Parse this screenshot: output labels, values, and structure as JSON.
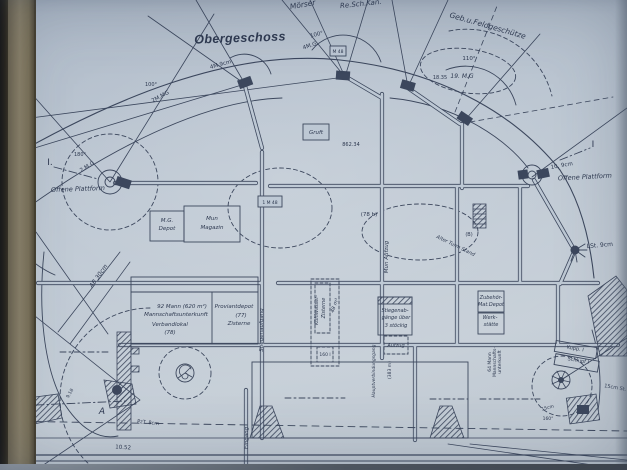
{
  "photo": {
    "frame_colors": {
      "outer": "#221c13",
      "inner": "#857b63",
      "edge_line": "#463f2f",
      "paper_edge": "#dbe1e9"
    },
    "paper_color": "#bdc8d4",
    "ink_color": "#2e3950",
    "shadow_color": "#545a61"
  },
  "plan": {
    "title": "Obergeschoss",
    "labels": [
      {
        "t": "Mörser",
        "x": 303,
        "y": 7,
        "s": 7.5,
        "r": -10,
        "i": 1
      },
      {
        "t": "Re.Sch.Kan.",
        "x": 361,
        "y": 6,
        "s": 7,
        "r": -6,
        "i": 1
      },
      {
        "t": "Geb.u.Feldgeschütze",
        "x": 487,
        "y": 28,
        "s": 7.5,
        "r": 16,
        "i": 1
      },
      {
        "t": "110°",
        "x": 469,
        "y": 60,
        "s": 5.5
      },
      {
        "t": "19. M.G",
        "x": 462,
        "y": 78,
        "s": 6,
        "i": 1
      },
      {
        "t": "100°",
        "x": 317,
        "y": 36,
        "s": 5.5,
        "r": -14
      },
      {
        "t": "4M.G.",
        "x": 311,
        "y": 47,
        "s": 5.5,
        "r": -18
      },
      {
        "t": "4M.9cm",
        "x": 221,
        "y": 66,
        "s": 5.5,
        "r": -16
      },
      {
        "t": "2M.MG",
        "x": 161,
        "y": 98,
        "s": 5.5,
        "r": -28
      },
      {
        "t": "100°",
        "x": 151,
        "y": 86,
        "s": 5
      },
      {
        "t": "2.M.G",
        "x": 88,
        "y": 168,
        "s": 5.5,
        "r": -32
      },
      {
        "t": "180°",
        "x": 80,
        "y": 156,
        "s": 5
      },
      {
        "t": "18.35",
        "x": 440,
        "y": 79,
        "s": 5
      },
      {
        "t": "I.",
        "x": 50,
        "y": 165,
        "s": 9
      },
      {
        "t": "Offene Plattform",
        "x": 78,
        "y": 191,
        "s": 6.5,
        "r": -2,
        "i": 1
      },
      {
        "t": "Offene Plattform",
        "x": 585,
        "y": 179,
        "s": 6.5,
        "r": -3,
        "i": 1
      },
      {
        "t": "10. 9cm",
        "x": 562,
        "y": 167,
        "s": 5.5,
        "r": -10
      },
      {
        "t": "I",
        "x": 593,
        "y": 147,
        "s": 9
      },
      {
        "t": "LSt. 9cm",
        "x": 600,
        "y": 247,
        "s": 6,
        "r": -5
      },
      {
        "t": "M.G.",
        "x": 167,
        "y": 222,
        "s": 5.5,
        "i": 1
      },
      {
        "t": "Depot",
        "x": 167,
        "y": 230,
        "s": 5.5,
        "i": 1
      },
      {
        "t": "Mun",
        "x": 212,
        "y": 220,
        "s": 5.5,
        "i": 1
      },
      {
        "t": "Magazin",
        "x": 212,
        "y": 229,
        "s": 5.5,
        "i": 1
      },
      {
        "t": "Gruft",
        "x": 316,
        "y": 134,
        "s": 5.5,
        "i": 1
      },
      {
        "t": "862.34",
        "x": 351,
        "y": 146,
        "s": 5
      },
      {
        "t": "1 M 48",
        "x": 270,
        "y": 204,
        "s": 4.5
      },
      {
        "t": "M 48",
        "x": 338,
        "y": 53,
        "s": 4.5
      },
      {
        "t": "(78 b)",
        "x": 369,
        "y": 216,
        "s": 5.5
      },
      {
        "t": "(B)",
        "x": 469,
        "y": 236,
        "s": 5
      },
      {
        "t": "Alter Turm Stand",
        "x": 455,
        "y": 247,
        "s": 5,
        "r": 26,
        "i": 1
      },
      {
        "t": "Mun Aufzug",
        "x": 388,
        "y": 257,
        "s": 5.5,
        "r": -90,
        "i": 1
      },
      {
        "t": "AB 30cm",
        "x": 100,
        "y": 277,
        "s": 6,
        "r": -55,
        "i": 1
      },
      {
        "t": "92 Mann (620 m²)",
        "x": 182,
        "y": 308,
        "s": 5.5,
        "i": 1
      },
      {
        "t": "Mannschaftsunterkunft",
        "x": 176,
        "y": 316,
        "s": 5.5,
        "i": 1
      },
      {
        "t": "Verbandlokal",
        "x": 170,
        "y": 326,
        "s": 5.5,
        "i": 1
      },
      {
        "t": "(78)",
        "x": 170,
        "y": 334,
        "s": 5.5,
        "i": 1
      },
      {
        "t": "Proviantdepot",
        "x": 234,
        "y": 308,
        "s": 5.5,
        "i": 1
      },
      {
        "t": "(77)",
        "x": 241,
        "y": 317,
        "s": 5.5,
        "i": 1
      },
      {
        "t": "Zisterne",
        "x": 239,
        "y": 325,
        "s": 5.5,
        "i": 1
      },
      {
        "t": "Stiegenaufgang",
        "x": 263,
        "y": 330,
        "s": 5.5,
        "r": -90,
        "i": 1
      },
      {
        "t": "Kühlwasser-",
        "x": 318,
        "y": 310,
        "s": 5,
        "r": -90,
        "i": 1
      },
      {
        "t": "Zisterne",
        "x": 325,
        "y": 308,
        "s": 5,
        "r": -90,
        "i": 1
      },
      {
        "t": "48 m³",
        "x": 336,
        "y": 306,
        "s": 5,
        "r": -70,
        "i": 1
      },
      {
        "t": "160 l",
        "x": 325,
        "y": 356,
        "s": 4.5
      },
      {
        "t": "Stiegenab-",
        "x": 395,
        "y": 312,
        "s": 5,
        "i": 1
      },
      {
        "t": "gänge über",
        "x": 396,
        "y": 319,
        "s": 5,
        "i": 1
      },
      {
        "t": "3 stöckig",
        "x": 396,
        "y": 327,
        "s": 5,
        "i": 1
      },
      {
        "t": "Aufzug",
        "x": 396,
        "y": 347,
        "s": 5,
        "i": 1
      },
      {
        "t": "Hauptverbindungsgang",
        "x": 375,
        "y": 371,
        "s": 4.5,
        "r": -90,
        "i": 1
      },
      {
        "t": "(383 m)",
        "x": 391,
        "y": 370,
        "s": 4.5,
        "r": -90
      },
      {
        "t": "Zubehör-",
        "x": 491,
        "y": 299,
        "s": 5,
        "i": 1
      },
      {
        "t": "Mat.Depot",
        "x": 491,
        "y": 306,
        "s": 5,
        "i": 1
      },
      {
        "t": "Werk-",
        "x": 490,
        "y": 319,
        "s": 5,
        "i": 1
      },
      {
        "t": "stätte",
        "x": 491,
        "y": 326,
        "s": 5,
        "i": 1
      },
      {
        "t": "64 Mann",
        "x": 491,
        "y": 362,
        "s": 4.5,
        "r": -90
      },
      {
        "t": "Mannschafts-",
        "x": 496,
        "y": 362,
        "s": 4.5,
        "r": -90
      },
      {
        "t": "unterkunft",
        "x": 501,
        "y": 362,
        "s": 4.5,
        "r": -90
      },
      {
        "t": "Kupp. I",
        "x": 575,
        "y": 350,
        "s": 5,
        "r": 10
      },
      {
        "t": "Schlupf I",
        "x": 578,
        "y": 362,
        "s": 5,
        "r": 10
      },
      {
        "t": "15cm St.",
        "x": 615,
        "y": 389,
        "s": 5,
        "r": 10
      },
      {
        "t": "15cm",
        "x": 548,
        "y": 409,
        "s": 4.5,
        "r": -15
      },
      {
        "t": "160°",
        "x": 548,
        "y": 420,
        "s": 4.5
      },
      {
        "t": "Eingang",
        "x": 248,
        "y": 438,
        "s": 5.5,
        "r": -90,
        "i": 1
      },
      {
        "t": "A",
        "x": 102,
        "y": 414,
        "s": 9,
        "i": 1
      },
      {
        "t": "I.",
        "x": 31,
        "y": 404,
        "s": 9
      },
      {
        "t": "PzT. 8cm",
        "x": 148,
        "y": 424,
        "s": 5,
        "r": 6
      },
      {
        "t": "10.52",
        "x": 123,
        "y": 449,
        "s": 5.5,
        "r": 4
      },
      {
        "t": "9.18",
        "x": 71,
        "y": 394,
        "s": 4.5,
        "r": -60
      }
    ]
  }
}
